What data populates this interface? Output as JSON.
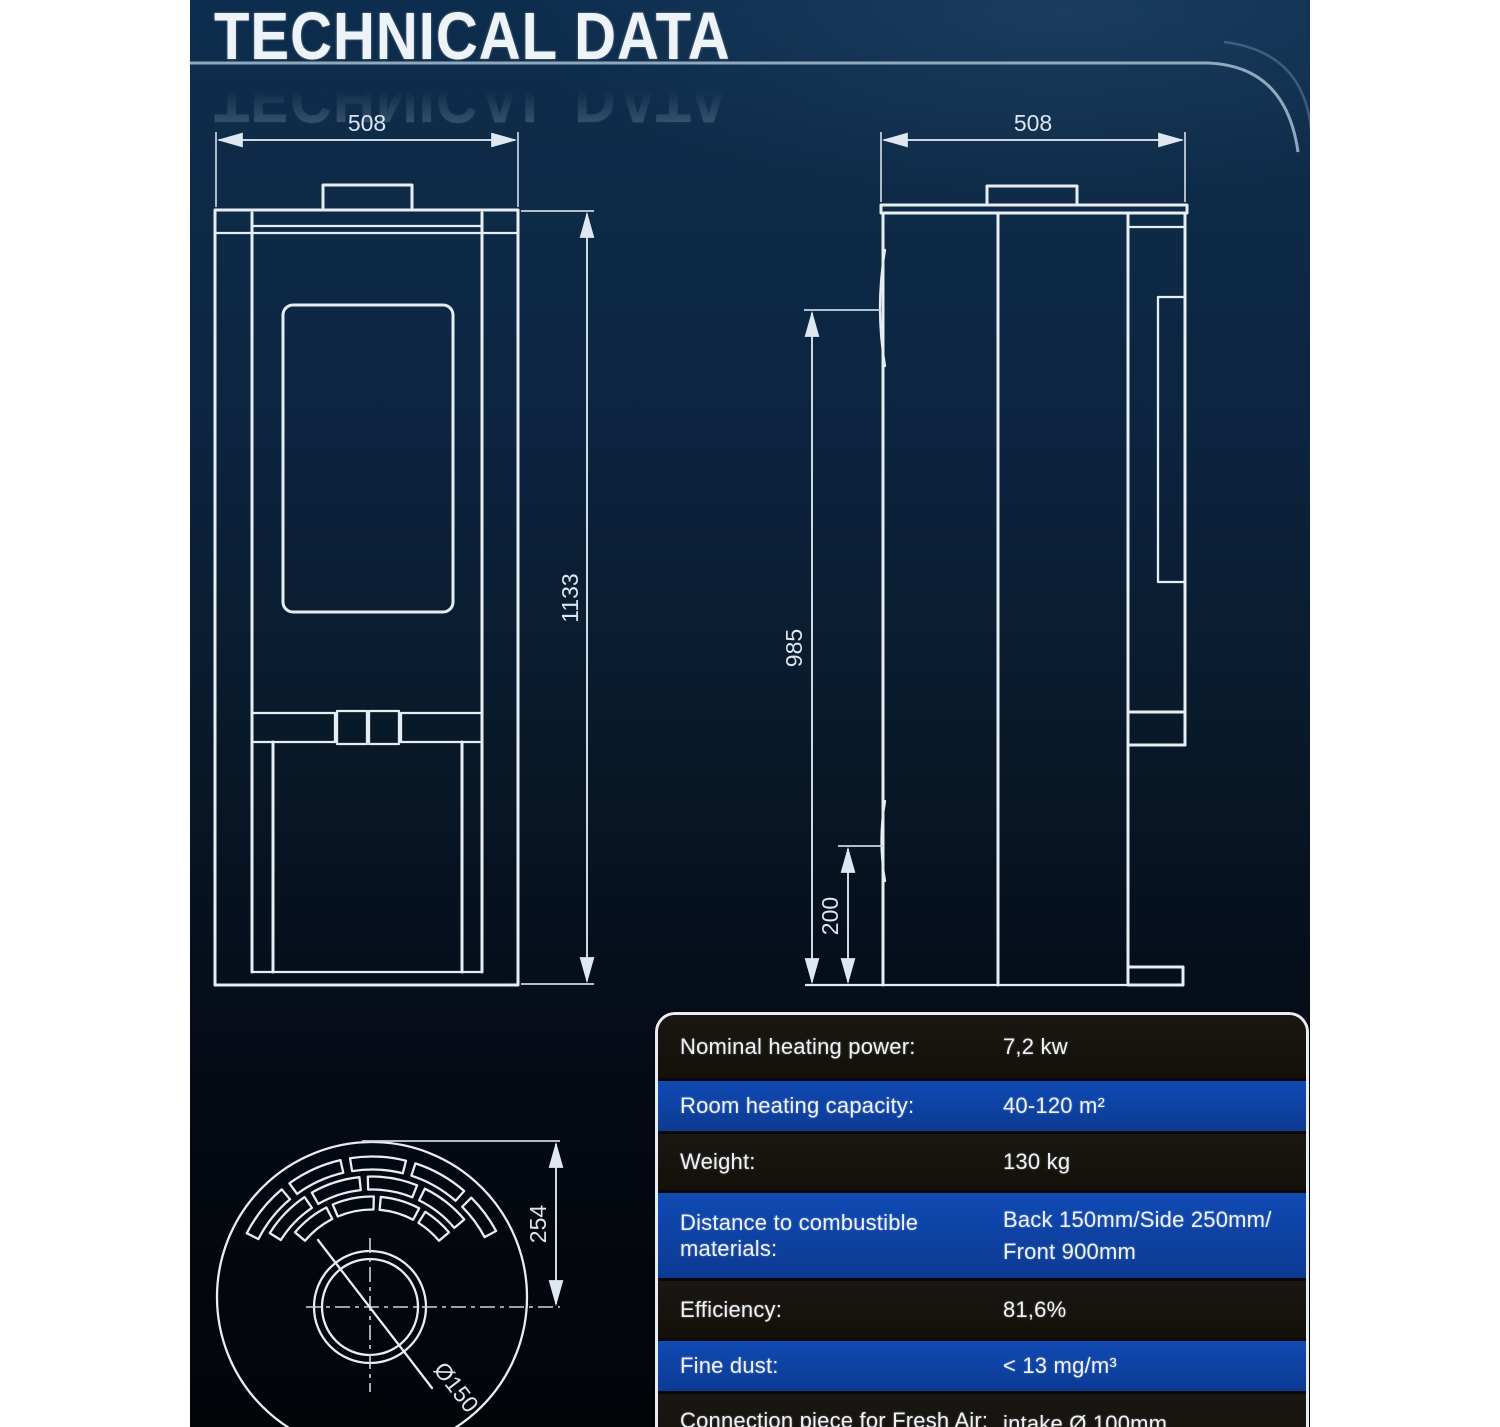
{
  "page": {
    "title": "TECHNICAL DATA"
  },
  "front_view": {
    "width_label": "508",
    "height_label": "1133"
  },
  "side_view": {
    "width_label": "508",
    "height_label": "985",
    "clearance_label": "200"
  },
  "top_view": {
    "radius_label": "254",
    "flue_label": "Ø150"
  },
  "spec_table": {
    "rows": [
      {
        "label": "Nominal heating power:",
        "value": "7,2 kw"
      },
      {
        "label": "Room heating capacity:",
        "value": "40-120 m²"
      },
      {
        "label": "Weight:",
        "value": "130 kg"
      },
      {
        "label": "Distance to combustible materials:",
        "value": "Back 150mm/Side 250mm/",
        "value2": "Front 900mm"
      },
      {
        "label": "Efficiency:",
        "value": "81,6%"
      },
      {
        "label": "Fine dust:",
        "value": "< 13 mg/m³"
      },
      {
        "label": "Connection piece for Fresh Air:",
        "value": "intake Ø 100mm"
      }
    ]
  },
  "colors": {
    "background_top": "#0d2d4e",
    "background_bottom": "#020408",
    "line": "#e6edf3",
    "row_blue": "#0d3fa3",
    "row_dark": "#16130f"
  }
}
